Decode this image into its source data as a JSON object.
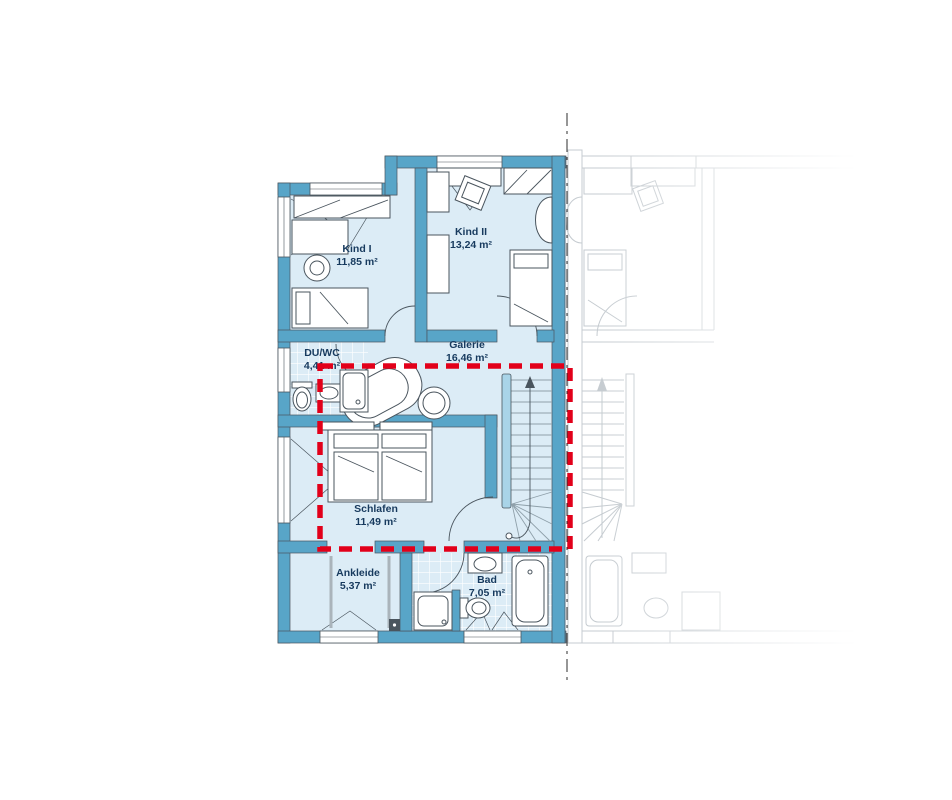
{
  "rooms": [
    {
      "name": "Kind I",
      "area": "11,85 m²"
    },
    {
      "name": "Kind II",
      "area": "13,24 m²"
    },
    {
      "name": "Galerie",
      "area": "16,46 m²"
    },
    {
      "name": "DU/WC",
      "area": "4,41 m²"
    },
    {
      "name": "Schlafen",
      "area": "11,49 m²"
    },
    {
      "name": "Ankleide",
      "area": "5,37 m²"
    },
    {
      "name": "Bad",
      "area": "7,05 m²"
    }
  ],
  "colors": {
    "wall": "#58a5c8",
    "room": "#dcecf6",
    "furn": "#4a555e",
    "text": "#173a5e",
    "highlight": "#e2001a",
    "neighbor": "#c5cbd0",
    "stair": "#8fa0aa",
    "stairrail": "#a9d4e8"
  }
}
